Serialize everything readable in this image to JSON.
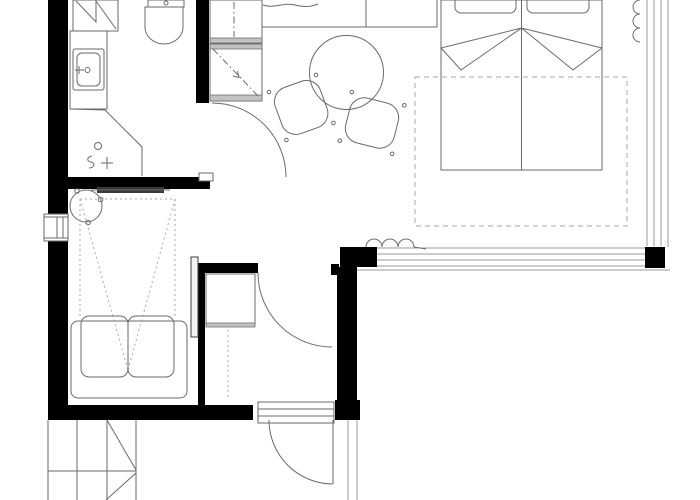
{
  "meta": {
    "kind": "architectural floor plan",
    "canvas_width": 700,
    "canvas_height": 500
  },
  "palette": {
    "background": "#ffffff",
    "wall": "#000000",
    "line": "#6a6a6a",
    "light": "#9a9a9a",
    "dash": "#a8a8a8",
    "tv": "#3a3a3a",
    "hatch": "#c2c2c2"
  },
  "rooms": [
    {
      "name": "bathroom",
      "fixtures": [
        "shower-unit",
        "vanity-counter",
        "wash-basin",
        "faucet",
        "toilet",
        "floor-drain",
        "shower-glass"
      ]
    },
    {
      "name": "kitchen",
      "fixtures": [
        "counter-with-sink",
        "tall-unit",
        "appliance-unit"
      ]
    },
    {
      "name": "dining-area",
      "fixtures": [
        "round-table",
        "dining-chair-left",
        "dining-chair-right"
      ]
    },
    {
      "name": "bedroom",
      "fixtures": [
        "double-bed",
        "pillow-left",
        "pillow-right",
        "blanket-folds",
        "rug",
        "curtain-east",
        "curtain-south",
        "window-east",
        "window-south"
      ]
    },
    {
      "name": "media-room",
      "fixtures": [
        "tv-screen",
        "projection-cone",
        "lounge-chair",
        "sofa",
        "sliding-door-panel",
        "window-west"
      ]
    },
    {
      "name": "entry-hall",
      "fixtures": [
        "wardrobe-cabinet",
        "interior-door",
        "entrance-door",
        "entrance-steps"
      ]
    },
    {
      "name": "exterior",
      "fixtures": [
        "outdoor-stairs"
      ]
    }
  ],
  "doors": [
    "bathroom-door",
    "hall-door",
    "entrance-door",
    "sliding-door-panel"
  ],
  "windows": [
    "window-west",
    "window-east",
    "window-south"
  ]
}
